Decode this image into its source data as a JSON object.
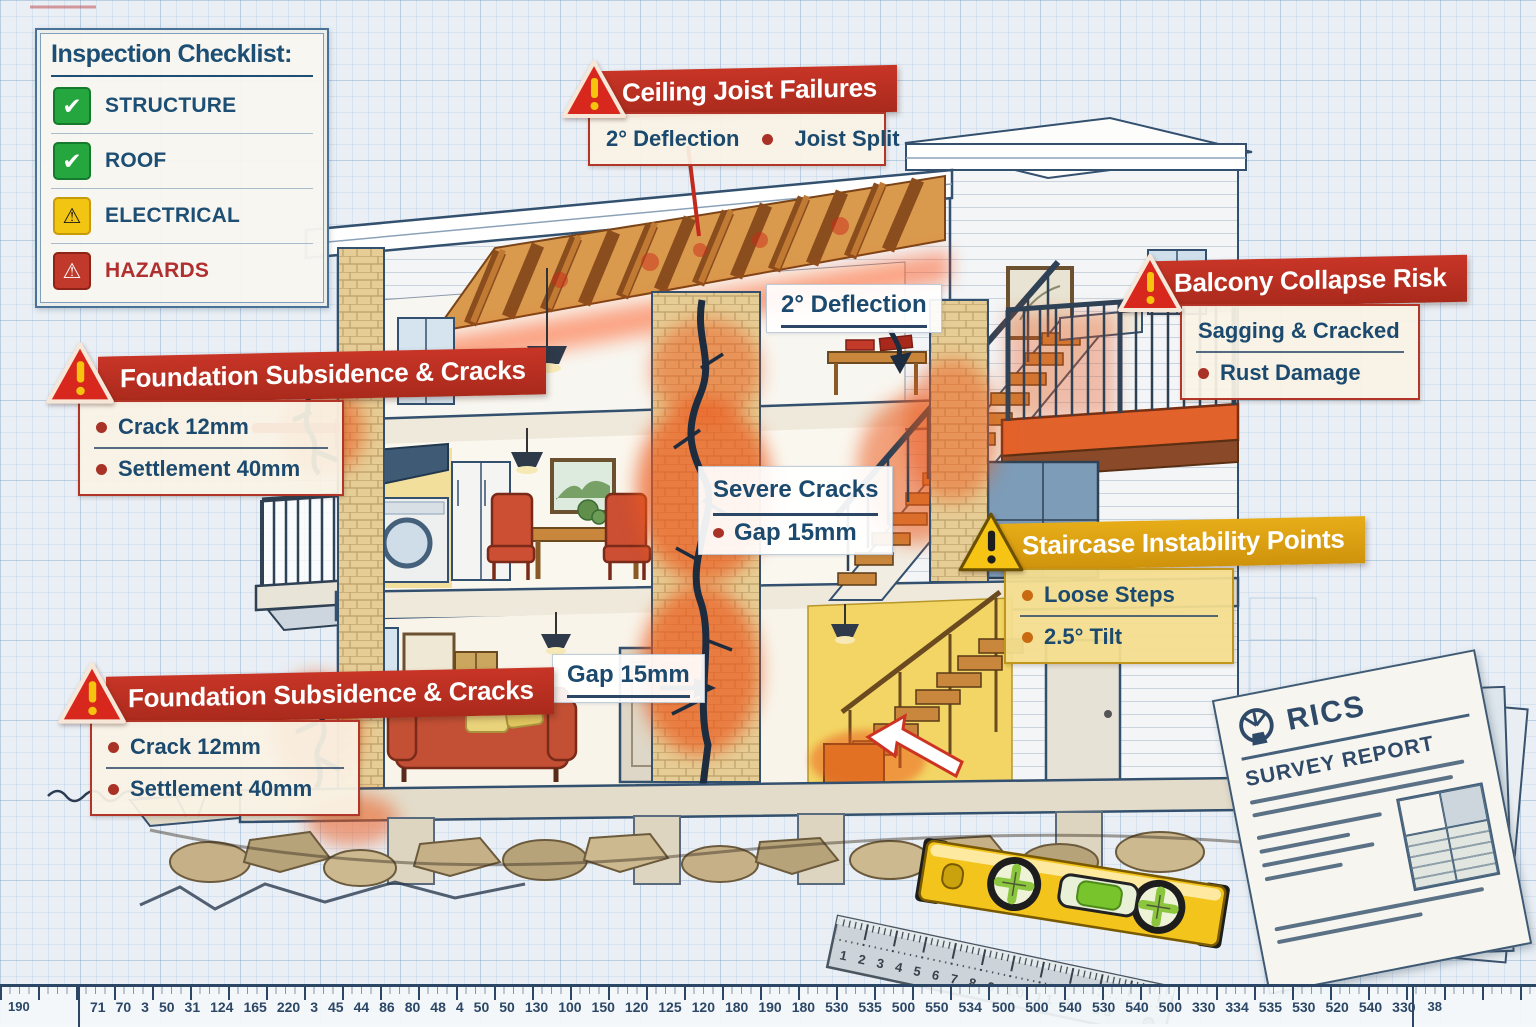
{
  "scene": {
    "type": "building-inspection-blueprint"
  },
  "checklist": {
    "title": "Inspection Checklist:",
    "items": [
      {
        "label": "STRUCTURE",
        "icon": "check-icon",
        "cls": "pass"
      },
      {
        "label": "ROOF",
        "icon": "check-icon",
        "cls": "pass"
      },
      {
        "label": "ELECTRICAL",
        "icon": "warning-icon",
        "cls": "warn"
      },
      {
        "label": "HAZARDS",
        "icon": "hazard-icon",
        "cls": "hazard"
      }
    ]
  },
  "callouts": {
    "ceiling_joist": {
      "icon": "warning-triangle-icon",
      "title": "Ceiling Joist Failures",
      "detail_left": "2° Deflection",
      "detail_right": "Joist Split"
    },
    "balcony": {
      "icon": "warning-triangle-icon",
      "title": "Balcony Collapse Risk",
      "line1": "Sagging & Cracked",
      "line2": "Rust Damage"
    },
    "foundation_upper": {
      "icon": "warning-triangle-icon",
      "title": "Foundation Subsidence & Cracks",
      "line1": "Crack 12mm",
      "line2": "Settlement 40mm"
    },
    "foundation_lower": {
      "icon": "warning-triangle-icon",
      "title": "Foundation Subsidence & Cracks",
      "line1": "Crack 12mm",
      "line2": "Settlement 40mm"
    },
    "staircase": {
      "icon": "warning-triangle-icon",
      "title": "Staircase Instability Points",
      "line1": "Loose Steps",
      "line2": "2.5° Tilt"
    }
  },
  "inline_labels": {
    "deflection": "2° Deflection",
    "severe_cracks_title": "Severe Cracks",
    "severe_cracks_gap": "Gap 15mm",
    "gap": "Gap 15mm"
  },
  "document": {
    "logo": "RICS",
    "title": "SURVEY REPORT"
  },
  "tools": {
    "ruler_numbers": "1 2 3 4 5 6 7 8 9 10 11 12 13"
  },
  "scale_bar": {
    "left_edge": "190",
    "right_edge": "38",
    "numbers": [
      "71",
      "70",
      "3",
      "50",
      "31",
      "124",
      "165",
      "220",
      "3",
      "45",
      "44",
      "86",
      "80",
      "48",
      "4",
      "50",
      "50",
      "130",
      "100",
      "150",
      "120",
      "125",
      "120",
      "180",
      "190",
      "180",
      "530",
      "535",
      "500",
      "550",
      "534",
      "500",
      "500",
      "540",
      "530",
      "540",
      "500",
      "330",
      "334",
      "535",
      "530",
      "520",
      "540",
      "330"
    ]
  },
  "colors": {
    "banner_red": "#bf3226",
    "banner_gold": "#e0a413",
    "text_navy": "#1c4a6e",
    "hazard_red": "#b03030",
    "damage_orange": "#e8541e",
    "check_green": "#26a63f",
    "warn_yellow": "#f3c513",
    "level_yellow": "#f3c41c",
    "wood": "#c8873c"
  }
}
